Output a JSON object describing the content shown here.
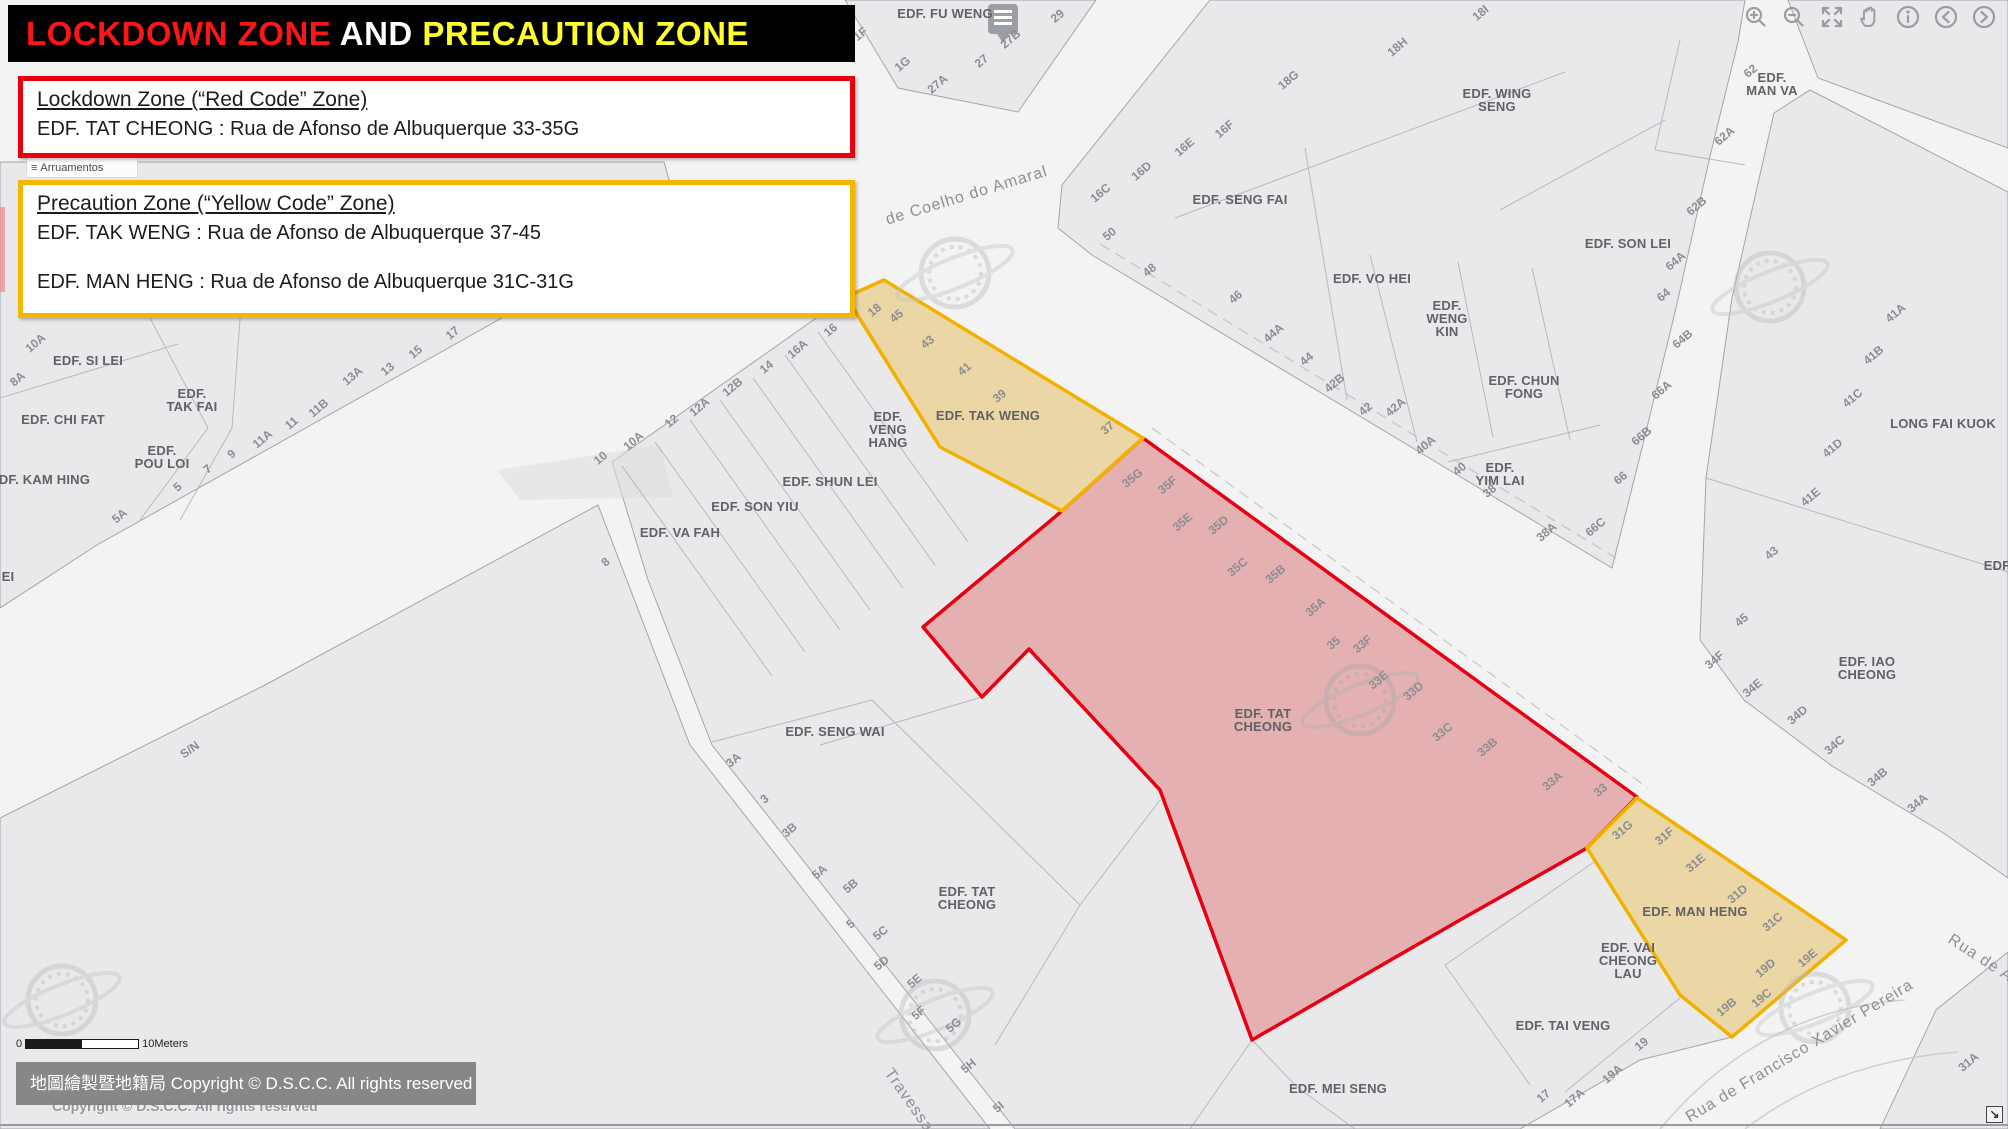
{
  "banner": {
    "part1": "LOCKDOWN ZONE",
    "part2": " AND ",
    "part3": "PRECAUTION ZONE",
    "color1": "#ff1515",
    "color2": "#ffffff",
    "color3": "#ffff2e"
  },
  "lockdown_box": {
    "title": "Lockdown Zone (“Red Code” Zone)",
    "line1": "EDF. TAT CHEONG : Rua de Afonso de Albuquerque 33-35G",
    "border_color": "#e8000d"
  },
  "precaution_box": {
    "title": "Precaution Zone (“Yellow Code” Zone)",
    "line1": "EDF. TAK WENG  : Rua de Afonso de Albuquerque 37-45",
    "line2": "EDF. MAN HENG  : Rua de Afonso de Albuquerque 31C-31G",
    "border_color": "#f3b700"
  },
  "legend_fragment": {
    "icon": "≡",
    "label": "Arruamentos"
  },
  "toolbar": {
    "buttons": [
      "zoom-in",
      "zoom-out",
      "fullscreen",
      "pan-hand",
      "info",
      "previous-extent",
      "next-extent"
    ]
  },
  "scale_bar": {
    "start": "0",
    "end": "10Meters"
  },
  "copyright": {
    "bar_text": "地圖繪製暨地籍局 Copyright © D.S.C.C. All rights reserved",
    "watermark_text": "Copyright © D.S.C.C. All rights reserved"
  },
  "corner": {
    "glyph": "↘"
  },
  "map": {
    "zones": [
      {
        "id": "lockdown-red",
        "stroke": "#e60012",
        "fill": "rgba(218,62,62,0.33)",
        "points": "1143,438 1062,511 923,627 982,697 1029,649 1160,790 1252,1040 1460,920 1587,848 1637,797"
      },
      {
        "id": "precaution-tak-weng",
        "stroke": "#f2b100",
        "fill": "rgba(238,189,72,0.42)",
        "points": "846,297 884,280 1143,438 1062,511 940,447"
      },
      {
        "id": "precaution-man-heng",
        "stroke": "#f2b100",
        "fill": "rgba(238,189,72,0.42)",
        "points": "1637,798 1846,940 1732,1037 1680,995 1587,848"
      }
    ],
    "labels": [
      {
        "t": "EDF. FU WENG",
        "x": 945,
        "y": 18,
        "r": 0,
        "c": "b"
      },
      {
        "t": "EDF. SAN IENG",
        "x": 253,
        "y": 60,
        "r": 0,
        "c": "b"
      },
      {
        "t": "EDF. WING\nSENG",
        "x": 1497,
        "y": 98,
        "r": 0,
        "c": "b"
      },
      {
        "t": "EDF.\nMAN VA",
        "x": 1772,
        "y": 82,
        "r": 0,
        "c": "b"
      },
      {
        "t": "EDF. SENG FAI",
        "x": 1240,
        "y": 204,
        "r": 0,
        "c": "b"
      },
      {
        "t": "EDF. VO HEI",
        "x": 1372,
        "y": 283,
        "r": 0,
        "c": "b"
      },
      {
        "t": "EDF.\nWENG\nKIN",
        "x": 1447,
        "y": 310,
        "r": 0,
        "c": "b"
      },
      {
        "t": "EDF. SON LEI",
        "x": 1628,
        "y": 248,
        "r": 0,
        "c": "b"
      },
      {
        "t": "EDF. CHUN\nFONG",
        "x": 1524,
        "y": 385,
        "r": 0,
        "c": "b"
      },
      {
        "t": "EDF.\nYIM LAI",
        "x": 1500,
        "y": 472,
        "r": 0,
        "c": "b"
      },
      {
        "t": "EDF. SI LEI",
        "x": 88,
        "y": 365,
        "r": 0,
        "c": "b"
      },
      {
        "t": "EDF. CHI FAT",
        "x": 63,
        "y": 424,
        "r": 0,
        "c": "b"
      },
      {
        "t": "EDF.\nTAK FAI",
        "x": 192,
        "y": 398,
        "r": 0,
        "c": "b"
      },
      {
        "t": "EDF.\nPOU LOI",
        "x": 162,
        "y": 455,
        "r": 0,
        "c": "b"
      },
      {
        "t": "EDF. KAM HING",
        "x": 40,
        "y": 484,
        "r": 0,
        "c": "b"
      },
      {
        "t": "EI",
        "x": 8,
        "y": 581,
        "r": 0,
        "c": "b"
      },
      {
        "t": "EDF.\nVENG\nHANG",
        "x": 888,
        "y": 421,
        "r": 0,
        "c": "b"
      },
      {
        "t": "EDF. TAK WENG",
        "x": 988,
        "y": 420,
        "r": 0,
        "c": "b"
      },
      {
        "t": "EDF. SHUN LEI",
        "x": 830,
        "y": 486,
        "r": 0,
        "c": "b"
      },
      {
        "t": "EDF. SON YIU",
        "x": 755,
        "y": 511,
        "r": 0,
        "c": "b"
      },
      {
        "t": "EDF. VA FAH",
        "x": 680,
        "y": 537,
        "r": 0,
        "c": "b"
      },
      {
        "t": "EDF. SENG WAI",
        "x": 835,
        "y": 736,
        "r": 0,
        "c": "b"
      },
      {
        "t": "EDF. TAT\nCHEONG",
        "x": 1263,
        "y": 718,
        "r": 0,
        "c": "b"
      },
      {
        "t": "EDF. TAT\nCHEONG",
        "x": 967,
        "y": 896,
        "r": 0,
        "c": "b"
      },
      {
        "t": "EDF. TAI VENG",
        "x": 1563,
        "y": 1030,
        "r": 0,
        "c": "b"
      },
      {
        "t": "EDF. VAI\nCHEONG\nLAU",
        "x": 1628,
        "y": 952,
        "r": 0,
        "c": "b"
      },
      {
        "t": "EDF. MAN HENG",
        "x": 1695,
        "y": 916,
        "r": 0,
        "c": "b"
      },
      {
        "t": "EDF. MEI SENG",
        "x": 1338,
        "y": 1093,
        "r": 0,
        "c": "b"
      },
      {
        "t": "LONG FAI KUOK",
        "x": 1943,
        "y": 428,
        "r": 0,
        "c": "b"
      },
      {
        "t": "EDF. IAO\nCHEONG",
        "x": 1867,
        "y": 666,
        "r": 0,
        "c": "b"
      },
      {
        "t": "EDF",
        "x": 1997,
        "y": 570,
        "r": 0,
        "c": "b"
      },
      {
        "t": "S/N",
        "x": 192,
        "y": 753,
        "r": -35,
        "c": "n"
      },
      {
        "t": "de Coelho do Amaral",
        "x": 968,
        "y": 200,
        "r": -17,
        "c": "s"
      },
      {
        "t": "Travessa",
        "x": 905,
        "y": 1103,
        "r": 55,
        "c": "s"
      },
      {
        "t": "Rua de Francisco Xavier Pereira",
        "x": 1802,
        "y": 1055,
        "r": -31,
        "c": "s"
      },
      {
        "t": "Rua de A",
        "x": 1978,
        "y": 962,
        "r": 33,
        "c": "s"
      },
      {
        "t": "1F",
        "x": 863,
        "y": 37,
        "r": -40,
        "c": "n"
      },
      {
        "t": "1G",
        "x": 905,
        "y": 67,
        "r": -40,
        "c": "n"
      },
      {
        "t": "27A",
        "x": 940,
        "y": 87,
        "r": -40,
        "c": "n"
      },
      {
        "t": "27",
        "x": 984,
        "y": 64,
        "r": -40,
        "c": "n"
      },
      {
        "t": "27B",
        "x": 1013,
        "y": 42,
        "r": -40,
        "c": "n"
      },
      {
        "t": "29",
        "x": 1060,
        "y": 19,
        "r": -40,
        "c": "n"
      },
      {
        "t": "18G",
        "x": 1291,
        "y": 83,
        "r": -40,
        "c": "n"
      },
      {
        "t": "18H",
        "x": 1400,
        "y": 50,
        "r": -40,
        "c": "n"
      },
      {
        "t": "18I",
        "x": 1483,
        "y": 16,
        "r": -40,
        "c": "n"
      },
      {
        "t": "16C",
        "x": 1103,
        "y": 196,
        "r": -40,
        "c": "n"
      },
      {
        "t": "16D",
        "x": 1144,
        "y": 174,
        "r": -40,
        "c": "n"
      },
      {
        "t": "16E",
        "x": 1187,
        "y": 150,
        "r": -40,
        "c": "n"
      },
      {
        "t": "16F",
        "x": 1227,
        "y": 132,
        "r": -40,
        "c": "n"
      },
      {
        "t": "50",
        "x": 1112,
        "y": 237,
        "r": -40,
        "c": "n"
      },
      {
        "t": "48",
        "x": 1152,
        "y": 273,
        "r": -40,
        "c": "n"
      },
      {
        "t": "46",
        "x": 1238,
        "y": 300,
        "r": -40,
        "c": "n"
      },
      {
        "t": "62",
        "x": 1753,
        "y": 74,
        "r": -40,
        "c": "n"
      },
      {
        "t": "62A",
        "x": 1727,
        "y": 139,
        "r": -40,
        "c": "n"
      },
      {
        "t": "62B",
        "x": 1699,
        "y": 209,
        "r": -40,
        "c": "n"
      },
      {
        "t": "64A",
        "x": 1678,
        "y": 264,
        "r": -40,
        "c": "n"
      },
      {
        "t": "64",
        "x": 1666,
        "y": 298,
        "r": -40,
        "c": "n"
      },
      {
        "t": "64B",
        "x": 1685,
        "y": 342,
        "r": -40,
        "c": "n"
      },
      {
        "t": "66A",
        "x": 1664,
        "y": 393,
        "r": -40,
        "c": "n"
      },
      {
        "t": "66B",
        "x": 1644,
        "y": 439,
        "r": -40,
        "c": "n"
      },
      {
        "t": "66",
        "x": 1623,
        "y": 481,
        "r": -40,
        "c": "n"
      },
      {
        "t": "66C",
        "x": 1598,
        "y": 530,
        "r": -40,
        "c": "n"
      },
      {
        "t": "44A",
        "x": 1276,
        "y": 336,
        "r": -40,
        "c": "n"
      },
      {
        "t": "44",
        "x": 1309,
        "y": 362,
        "r": -40,
        "c": "n"
      },
      {
        "t": "42B",
        "x": 1337,
        "y": 386,
        "r": -40,
        "c": "n"
      },
      {
        "t": "42",
        "x": 1368,
        "y": 412,
        "r": -40,
        "c": "n"
      },
      {
        "t": "42A",
        "x": 1398,
        "y": 410,
        "r": -40,
        "c": "n"
      },
      {
        "t": "40A",
        "x": 1428,
        "y": 448,
        "r": -40,
        "c": "n"
      },
      {
        "t": "40",
        "x": 1462,
        "y": 472,
        "r": -40,
        "c": "n"
      },
      {
        "t": "38",
        "x": 1492,
        "y": 494,
        "r": -40,
        "c": "n"
      },
      {
        "t": "38A",
        "x": 1549,
        "y": 535,
        "r": -40,
        "c": "n"
      },
      {
        "t": "8A",
        "x": 20,
        "y": 382,
        "r": -40,
        "c": "n"
      },
      {
        "t": "10A",
        "x": 38,
        "y": 346,
        "r": -40,
        "c": "n"
      },
      {
        "t": "5A",
        "x": 122,
        "y": 519,
        "r": -40,
        "c": "n"
      },
      {
        "t": "5",
        "x": 180,
        "y": 490,
        "r": -40,
        "c": "n"
      },
      {
        "t": "7",
        "x": 210,
        "y": 472,
        "r": -40,
        "c": "n"
      },
      {
        "t": "9",
        "x": 234,
        "y": 457,
        "r": -40,
        "c": "n"
      },
      {
        "t": "11A",
        "x": 265,
        "y": 442,
        "r": -40,
        "c": "n"
      },
      {
        "t": "11",
        "x": 294,
        "y": 426,
        "r": -40,
        "c": "n"
      },
      {
        "t": "11B",
        "x": 321,
        "y": 411,
        "r": -40,
        "c": "n"
      },
      {
        "t": "13A",
        "x": 355,
        "y": 379,
        "r": -40,
        "c": "n"
      },
      {
        "t": "13",
        "x": 390,
        "y": 372,
        "r": -40,
        "c": "n"
      },
      {
        "t": "15",
        "x": 418,
        "y": 355,
        "r": -40,
        "c": "n"
      },
      {
        "t": "17",
        "x": 455,
        "y": 336,
        "r": -40,
        "c": "n"
      },
      {
        "t": "10",
        "x": 603,
        "y": 461,
        "r": -40,
        "c": "n"
      },
      {
        "t": "10A",
        "x": 636,
        "y": 444,
        "r": -40,
        "c": "n"
      },
      {
        "t": "12",
        "x": 674,
        "y": 424,
        "r": -40,
        "c": "n"
      },
      {
        "t": "12A",
        "x": 702,
        "y": 410,
        "r": -40,
        "c": "n"
      },
      {
        "t": "12B",
        "x": 735,
        "y": 390,
        "r": -40,
        "c": "n"
      },
      {
        "t": "14",
        "x": 769,
        "y": 370,
        "r": -40,
        "c": "n"
      },
      {
        "t": "16A",
        "x": 800,
        "y": 352,
        "r": -40,
        "c": "n"
      },
      {
        "t": "16",
        "x": 833,
        "y": 333,
        "r": -40,
        "c": "n"
      },
      {
        "t": "8",
        "x": 608,
        "y": 565,
        "r": -40,
        "c": "n"
      },
      {
        "t": "18",
        "x": 877,
        "y": 313,
        "r": -40,
        "c": "n"
      },
      {
        "t": "45",
        "x": 899,
        "y": 319,
        "r": -40,
        "c": "n"
      },
      {
        "t": "43",
        "x": 930,
        "y": 345,
        "r": -40,
        "c": "n"
      },
      {
        "t": "41",
        "x": 967,
        "y": 372,
        "r": -40,
        "c": "n"
      },
      {
        "t": "39",
        "x": 1002,
        "y": 399,
        "r": -40,
        "c": "n"
      },
      {
        "t": "37",
        "x": 1110,
        "y": 431,
        "r": -40,
        "c": "n"
      },
      {
        "t": "35G",
        "x": 1135,
        "y": 481,
        "r": -40,
        "c": "n"
      },
      {
        "t": "35F",
        "x": 1170,
        "y": 488,
        "r": -40,
        "c": "n"
      },
      {
        "t": "35E",
        "x": 1185,
        "y": 525,
        "r": -40,
        "c": "n"
      },
      {
        "t": "35D",
        "x": 1221,
        "y": 528,
        "r": -40,
        "c": "n"
      },
      {
        "t": "35C",
        "x": 1240,
        "y": 570,
        "r": -40,
        "c": "n"
      },
      {
        "t": "35B",
        "x": 1278,
        "y": 577,
        "r": -40,
        "c": "n"
      },
      {
        "t": "35A",
        "x": 1318,
        "y": 610,
        "r": -40,
        "c": "n"
      },
      {
        "t": "35",
        "x": 1336,
        "y": 646,
        "r": -40,
        "c": "n"
      },
      {
        "t": "33F",
        "x": 1365,
        "y": 647,
        "r": -40,
        "c": "n"
      },
      {
        "t": "33E",
        "x": 1381,
        "y": 683,
        "r": -40,
        "c": "n"
      },
      {
        "t": "33D",
        "x": 1416,
        "y": 694,
        "r": -40,
        "c": "n"
      },
      {
        "t": "33C",
        "x": 1445,
        "y": 735,
        "r": -40,
        "c": "n"
      },
      {
        "t": "33B",
        "x": 1490,
        "y": 750,
        "r": -40,
        "c": "n"
      },
      {
        "t": "33A",
        "x": 1555,
        "y": 784,
        "r": -40,
        "c": "n"
      },
      {
        "t": "33",
        "x": 1603,
        "y": 793,
        "r": -40,
        "c": "n"
      },
      {
        "t": "31G",
        "x": 1625,
        "y": 833,
        "r": -40,
        "c": "n"
      },
      {
        "t": "31F",
        "x": 1667,
        "y": 839,
        "r": -40,
        "c": "n"
      },
      {
        "t": "31E",
        "x": 1698,
        "y": 866,
        "r": -40,
        "c": "n"
      },
      {
        "t": "31D",
        "x": 1740,
        "y": 897,
        "r": -40,
        "c": "n"
      },
      {
        "t": "31C",
        "x": 1775,
        "y": 925,
        "r": -40,
        "c": "n"
      },
      {
        "t": "19B",
        "x": 1729,
        "y": 1010,
        "r": -40,
        "c": "n"
      },
      {
        "t": "19C",
        "x": 1764,
        "y": 1001,
        "r": -40,
        "c": "n"
      },
      {
        "t": "19D",
        "x": 1768,
        "y": 971,
        "r": -40,
        "c": "n"
      },
      {
        "t": "19E",
        "x": 1810,
        "y": 961,
        "r": -40,
        "c": "n"
      },
      {
        "t": "3A",
        "x": 736,
        "y": 763,
        "r": -40,
        "c": "n"
      },
      {
        "t": "3",
        "x": 767,
        "y": 802,
        "r": -40,
        "c": "n"
      },
      {
        "t": "3B",
        "x": 792,
        "y": 833,
        "r": -40,
        "c": "n"
      },
      {
        "t": "5A",
        "x": 822,
        "y": 875,
        "r": -40,
        "c": "n"
      },
      {
        "t": "5B",
        "x": 853,
        "y": 889,
        "r": -40,
        "c": "n"
      },
      {
        "t": "5",
        "x": 853,
        "y": 927,
        "r": -40,
        "c": "n"
      },
      {
        "t": "5C",
        "x": 883,
        "y": 936,
        "r": -40,
        "c": "n"
      },
      {
        "t": "5D",
        "x": 884,
        "y": 966,
        "r": -40,
        "c": "n"
      },
      {
        "t": "5E",
        "x": 917,
        "y": 984,
        "r": -40,
        "c": "n"
      },
      {
        "t": "5F",
        "x": 921,
        "y": 1016,
        "r": -40,
        "c": "n"
      },
      {
        "t": "5G",
        "x": 956,
        "y": 1028,
        "r": -40,
        "c": "n"
      },
      {
        "t": "5H",
        "x": 971,
        "y": 1069,
        "r": -40,
        "c": "n"
      },
      {
        "t": "5I",
        "x": 1001,
        "y": 1110,
        "r": -40,
        "c": "n"
      },
      {
        "t": "17",
        "x": 1546,
        "y": 1099,
        "r": -40,
        "c": "n"
      },
      {
        "t": "17A",
        "x": 1577,
        "y": 1101,
        "r": -40,
        "c": "n"
      },
      {
        "t": "19A",
        "x": 1615,
        "y": 1077,
        "r": -40,
        "c": "n"
      },
      {
        "t": "19",
        "x": 1644,
        "y": 1047,
        "r": -40,
        "c": "n"
      },
      {
        "t": "34B",
        "x": 1880,
        "y": 780,
        "r": -40,
        "c": "n"
      },
      {
        "t": "34A",
        "x": 1920,
        "y": 806,
        "r": -40,
        "c": "n"
      },
      {
        "t": "31A",
        "x": 1971,
        "y": 1065,
        "r": -40,
        "c": "n"
      },
      {
        "t": "41A",
        "x": 1898,
        "y": 316,
        "r": -40,
        "c": "n"
      },
      {
        "t": "41B",
        "x": 1876,
        "y": 358,
        "r": -40,
        "c": "n"
      },
      {
        "t": "41C",
        "x": 1855,
        "y": 401,
        "r": -40,
        "c": "n"
      },
      {
        "t": "41D",
        "x": 1835,
        "y": 451,
        "r": -40,
        "c": "n"
      },
      {
        "t": "41E",
        "x": 1813,
        "y": 500,
        "r": -40,
        "c": "n"
      },
      {
        "t": "43",
        "x": 1774,
        "y": 556,
        "r": -40,
        "c": "n"
      },
      {
        "t": "45",
        "x": 1744,
        "y": 623,
        "r": -40,
        "c": "n"
      },
      {
        "t": "34F",
        "x": 1717,
        "y": 663,
        "r": -40,
        "c": "n"
      },
      {
        "t": "34E",
        "x": 1755,
        "y": 691,
        "r": -40,
        "c": "n"
      },
      {
        "t": "34D",
        "x": 1800,
        "y": 718,
        "r": -40,
        "c": "n"
      },
      {
        "t": "34C",
        "x": 1837,
        "y": 748,
        "r": -40,
        "c": "n"
      }
    ]
  }
}
